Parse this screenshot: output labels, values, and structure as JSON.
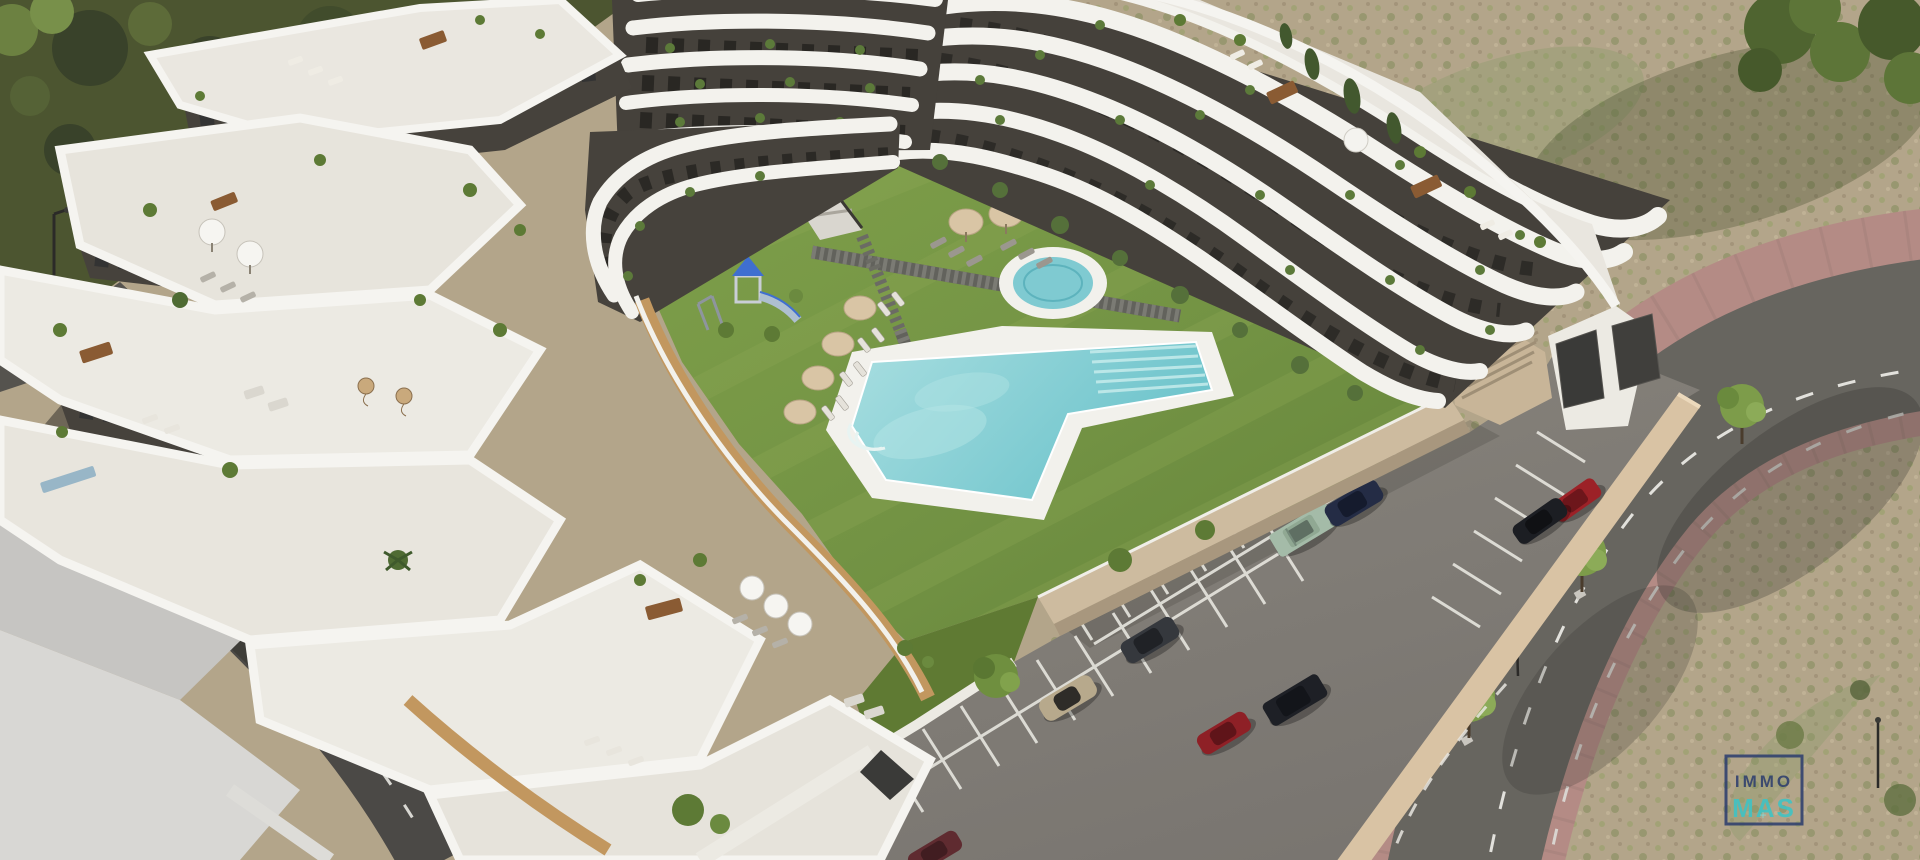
{
  "image": {
    "type": "aerial-3d-architectural-render",
    "subject": "modern white terraced apartment complex with central courtyard, angular swimming pool, round jacuzzi, playground, gardens, outdoor parking and surrounding streets"
  },
  "watermark": {
    "line1": "IMMO",
    "line2": "MAS",
    "plus_glyph": "+",
    "color_primary": "#2e3f6e",
    "color_accent": "#3dc4c6"
  },
  "palette": {
    "pool_water": "#84cdd3",
    "jacuzzi_water": "#7fcad1",
    "lawn_green": "#76984408",
    "scrubland": "#b3a58a",
    "parking_asphalt": "#837f77",
    "road": "#67655f",
    "sidewalk_pink": "#b48b85",
    "sidewalk_maroon": "#5d4548",
    "building_white": "#f3f2ed",
    "facade_dark": "#45413b",
    "terrace_floor": "#e9e6df"
  }
}
